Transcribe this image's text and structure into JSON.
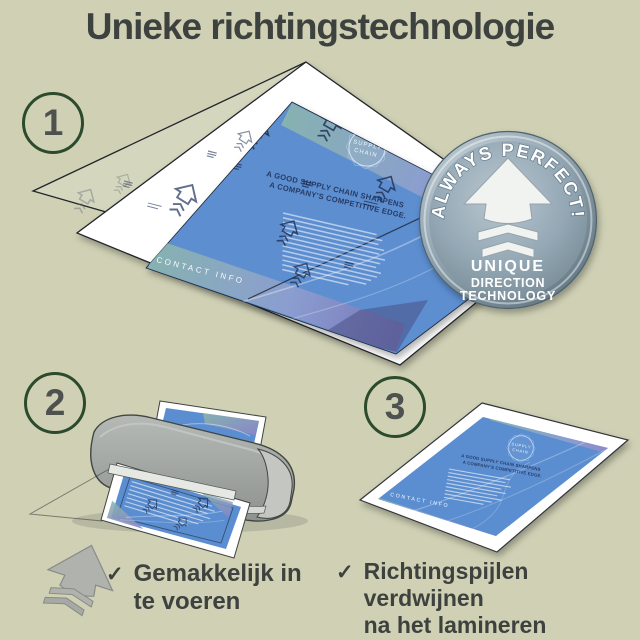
{
  "title": "Unieke richtingstechnologie",
  "steps": [
    {
      "number": "1"
    },
    {
      "number": "2"
    },
    {
      "number": "3"
    }
  ],
  "badge": {
    "arc_text": "ALWAYS PERFECT!",
    "line1": "UNIQUE",
    "line2": "DIRECTION",
    "line3": "TECHNOLOGY"
  },
  "document": {
    "company": "BBL CONSULTING",
    "logo_line1": "SUPPLY",
    "logo_line2": "CHAIN",
    "headline1": "A GOOD SUPPLY CHAIN SHARPENS",
    "headline2": "A COMPANY'S COMPETITIVE EDGE.",
    "footer": "CONTACT INFO"
  },
  "bullets": [
    {
      "checkmark": "✓",
      "line1": "Gemakkelijk in",
      "line2": "te voeren"
    },
    {
      "checkmark": "✓",
      "line1": "Richtingspijlen verdwijnen",
      "line2": "na het lamineren"
    }
  ],
  "colors": {
    "background": "#cfd0b4",
    "heading_text": "#3d423f",
    "step_circle_border": "#2c4a2c",
    "step_number": "#4e524e",
    "document_blue": "#5b8ed0",
    "gradient_teal": "#8ab5ae",
    "gradient_purple": "#8d85c6",
    "badge_steel": "#8ba0af",
    "machine_gray": "#9da19e",
    "arrow_gray": "#b0b3ad"
  }
}
